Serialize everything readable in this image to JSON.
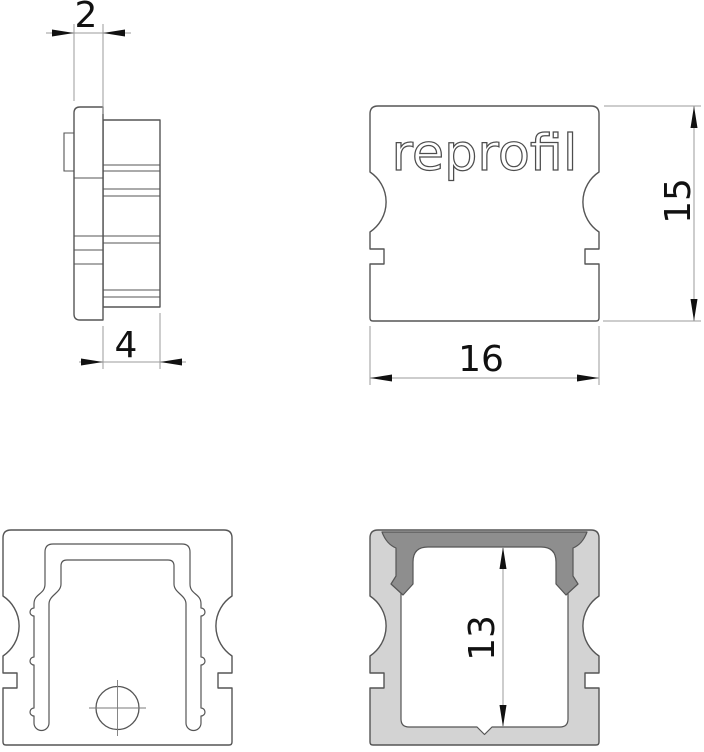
{
  "logo": "reprofil",
  "dimensions": {
    "side_view": {
      "flange_thickness": "2",
      "cap_depth": "4"
    },
    "front_view": {
      "height": "15",
      "width": "16"
    },
    "section_view": {
      "inner_height": "13"
    }
  },
  "colors": {
    "background": "#ffffff",
    "part_line": "#555555",
    "dimension_line": "#9b9b9b",
    "dimension_text": "#111111",
    "profile_fill_light": "#d3d3d3",
    "profile_fill_dark": "#8e8e8e",
    "logo_stroke": "#4d4d4d"
  }
}
